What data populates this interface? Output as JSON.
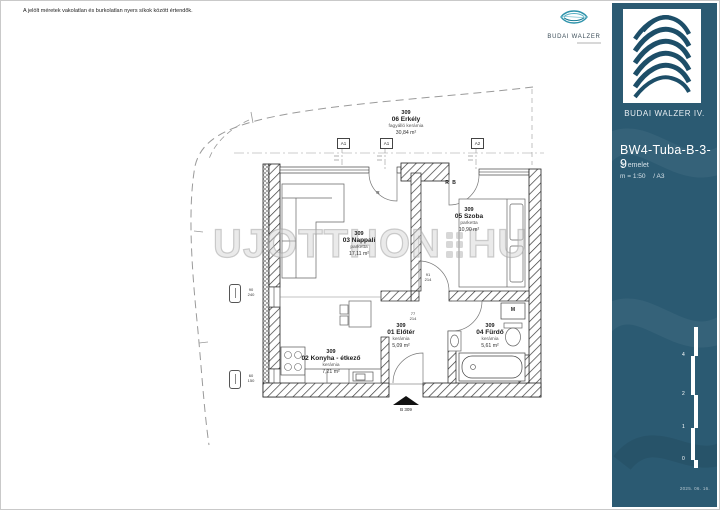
{
  "disclaimer": "A jelölt méretek vakolatlan és burkolatlan nyers síkok között értendők.",
  "watermark": {
    "left": "UJOTTHON",
    "right": "HU"
  },
  "top_logo": {
    "name": "BUDAI WALZER"
  },
  "sidebar": {
    "accent_color": "#2b5a72",
    "brand": "BUDAI WALZER IV.",
    "unit_code": "BW4-Tuba-B-3-9",
    "floor": "3. emelet",
    "scale": "m = 1:50",
    "sheet": "/ A3",
    "scalebar_labels": [
      "4",
      "2",
      "1",
      "0"
    ],
    "date": "2025. 06. 16."
  },
  "plan": {
    "rooms": [
      {
        "id": "309",
        "num_name": "06 Erkély",
        "finish": "fagyálló kerámia",
        "area": "30,84 m²"
      },
      {
        "id": "309",
        "num_name": "03 Nappali",
        "finish": "parketta",
        "area": "17,11 m²"
      },
      {
        "id": "309",
        "num_name": "05 Szoba",
        "finish": "parketta",
        "area": "10,90 m²"
      },
      {
        "id": "309",
        "num_name": "01 Előtér",
        "finish": "kerámia",
        "area": "5,09 m²"
      },
      {
        "id": "309",
        "num_name": "04 Fürdő",
        "finish": "kerámia",
        "area": "5,61 m²"
      },
      {
        "id": "309",
        "num_name": "02 Konyha - étkező",
        "finish": "kerámia",
        "area": "7,21 m²"
      }
    ],
    "axis_markers": [
      "A1",
      "A1",
      "A2"
    ],
    "entrance_label": "B 309",
    "door_labels": {
      "rb": "R B",
      "r": "R",
      "m": "M"
    },
    "window_dims": [
      [
        "90",
        "240"
      ],
      [
        "60",
        "150"
      ]
    ],
    "door_dims": [
      [
        "91",
        "214"
      ],
      [
        "77",
        "214"
      ]
    ]
  }
}
